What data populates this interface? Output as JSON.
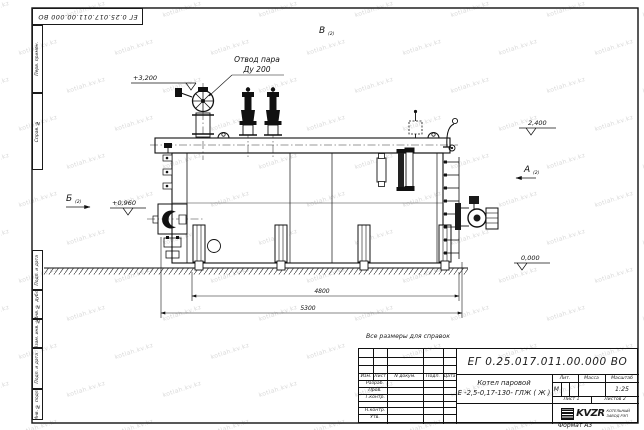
{
  "watermark": {
    "text": "kotlah.kv.kz"
  },
  "margin_labels": [
    "Перв. примен.",
    "Справ. №",
    "Подп. и дата",
    "Инв. № дубл.",
    "Взам. инв. №",
    "Подп. и дата",
    "Инв. № подл."
  ],
  "note": "Все размеры для справок",
  "drawing": {
    "callout": {
      "line1": "Отвод пара",
      "line2": "Ду 200"
    },
    "elevations": {
      "e3200": "+3,200",
      "e2400": "2,400",
      "e0960": "+0,960",
      "e0000": "0,000"
    },
    "dims": {
      "legs": "4800",
      "overall": "5300"
    },
    "views": {
      "top": "В",
      "right": "А",
      "left": "Б",
      "sheet_ref": "(2)"
    }
  },
  "title_block": {
    "doc_number": "ЕГ 0.25.017.011.00.000  ВО",
    "product_line1": "Котел паровой",
    "product_line2": "Е -2,5-0,17-130- ГЛЖ ( Ж )",
    "cols": {
      "izm": "Изм.",
      "list": "Лист",
      "doc": "N докум.",
      "podp": "Подп.",
      "data": "Дата"
    },
    "rows": {
      "razrab": "Разраб.",
      "prov": "Пров.",
      "tkontr": "Т.контр.",
      "nkontr": "Н.контр.",
      "utv": "Утв."
    },
    "lit_header": "Лит.",
    "mass_header": "Масса",
    "scale_header": "Масштаб",
    "lit_value": "М",
    "scale_value": "1:25",
    "sheet": "Лист 1",
    "sheets": "Листов 2",
    "org_name": "KVZR",
    "org_sub1": "КОТЕЛЬНЫЙ",
    "org_sub2": "ЗАВОД РЭП",
    "format": "Формат А3"
  }
}
